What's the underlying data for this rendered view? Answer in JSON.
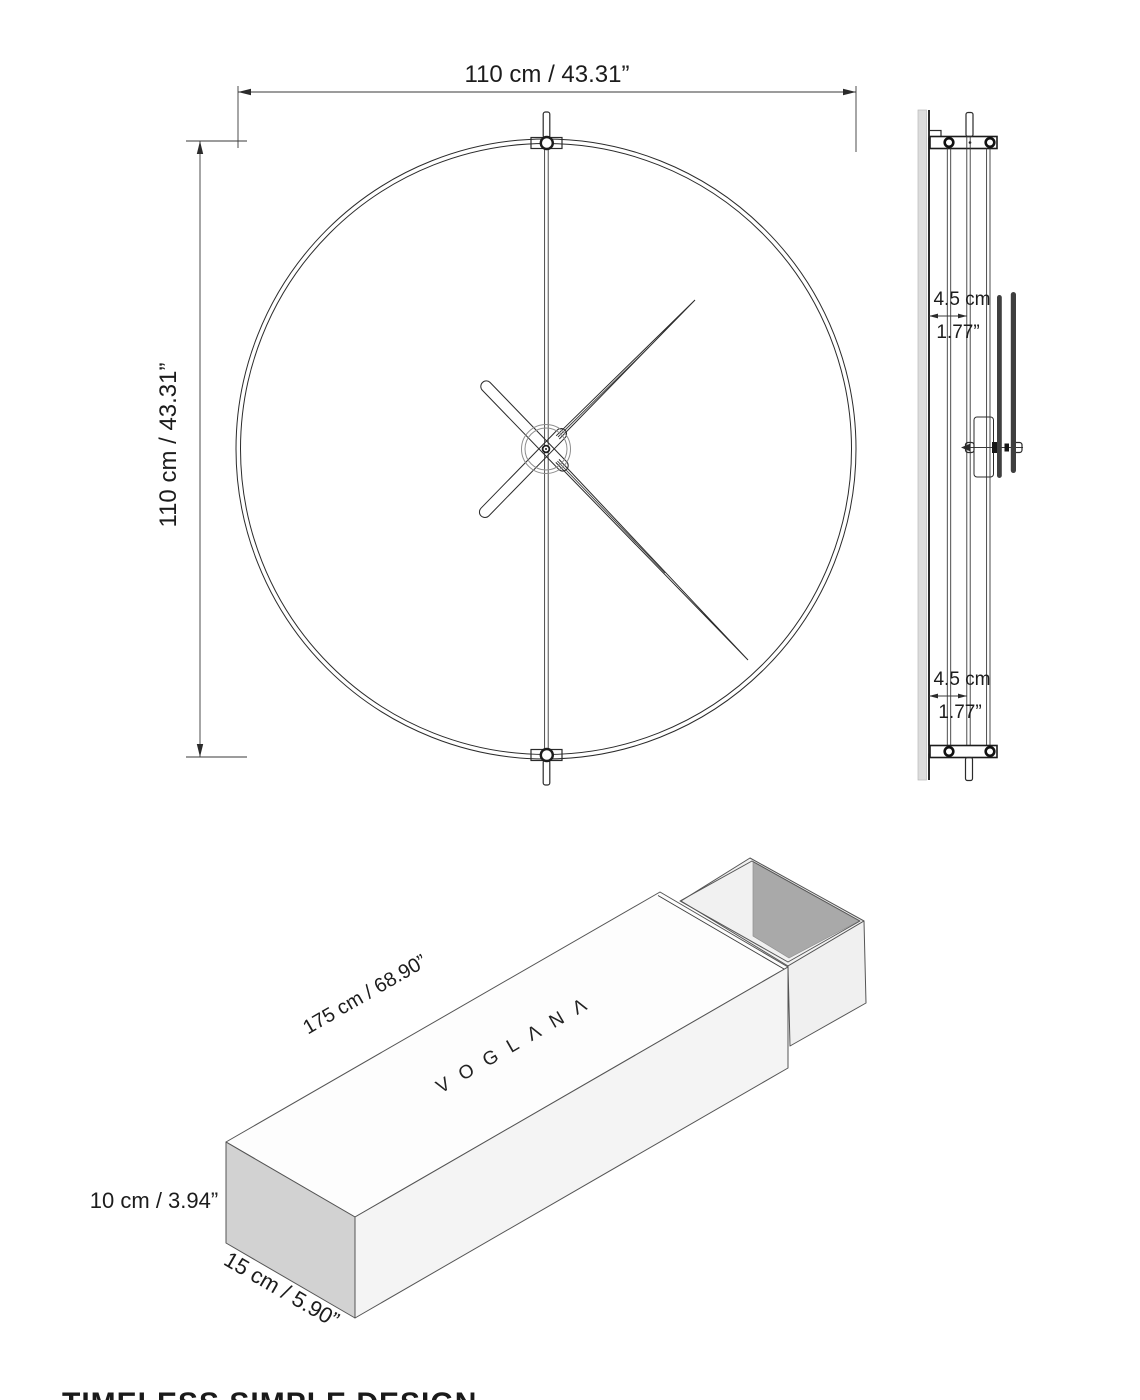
{
  "front_view": {
    "width_label": "110 cm / 43.31”",
    "height_label": "110 cm / 43.31”"
  },
  "side_view": {
    "top_depth_cm": "4.5 cm",
    "top_depth_in": "1.77”",
    "bottom_depth_cm": "4.5 cm",
    "bottom_depth_in": "1.77”"
  },
  "box_view": {
    "length_label": "175 cm / 68.90”",
    "brand": "VOGLΛNΛ",
    "height_label": "10 cm / 3.94”",
    "width_label": "15 cm / 5.90”"
  },
  "footer": {
    "caption": "TIMELESS SIMPLE DESIGN"
  },
  "colors": {
    "line": "#2b2b2b",
    "wall": "#dcdcdc",
    "box_left_face": "#d2d2d2",
    "box_front_face": "#f4f4f4",
    "tray_dark_wall": "#a9a9a9",
    "tray_cavity": "#f1f1f1"
  }
}
